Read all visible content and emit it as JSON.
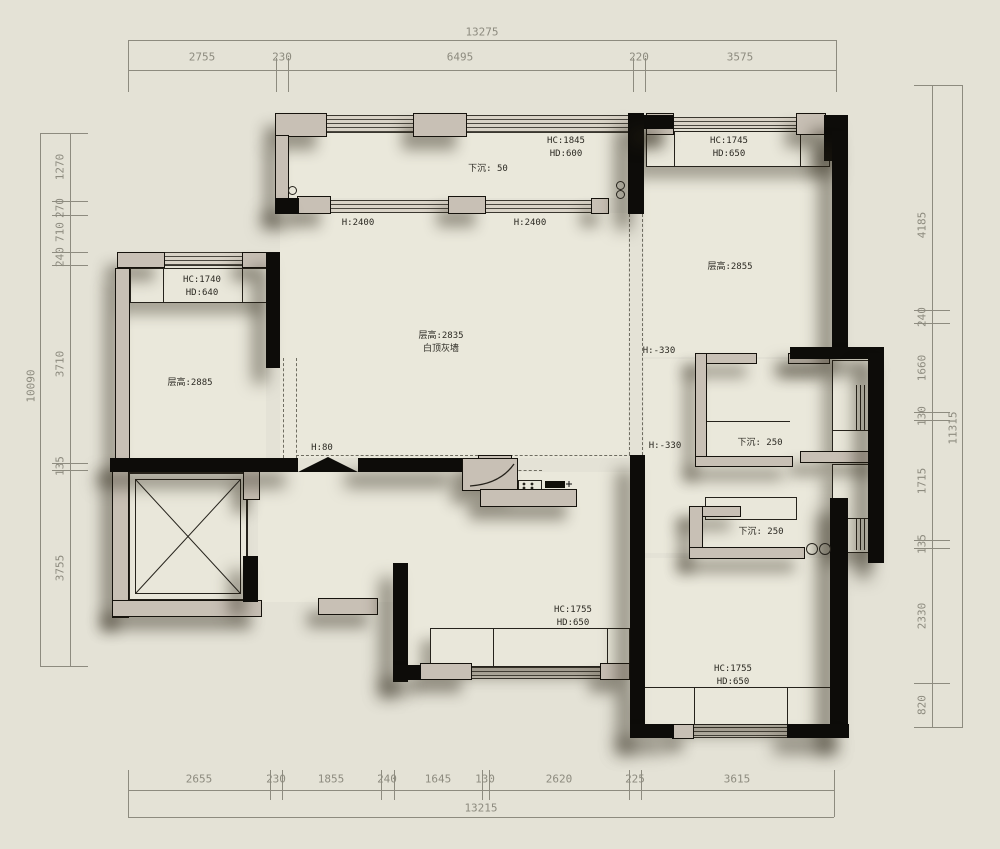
{
  "title": "apartment floor plan",
  "colors": {
    "background": "#e4e2d6",
    "wall": "#0d0c09",
    "trim": "#c8c0b5",
    "floor": "#eae8db",
    "dimension_text": "#8d8b7f",
    "annotation_text": "#2c2a23"
  },
  "dim_chains": {
    "top": {
      "total": "13275",
      "segments": [
        "2755",
        "230",
        "6495",
        "220",
        "3575"
      ]
    },
    "bottom": {
      "total": "13215",
      "segments": [
        "2655",
        "230",
        "1855",
        "240",
        "1645",
        "130",
        "2620",
        "225",
        "3615"
      ]
    },
    "left": {
      "total": "10090",
      "segments": [
        "1270",
        "270",
        "710",
        "240",
        "3710",
        "135",
        "3755"
      ]
    },
    "right": {
      "total": "11315",
      "segments": [
        "4185",
        "240",
        "1660",
        "130",
        "1715",
        "135",
        "2330",
        "820"
      ]
    }
  },
  "room_labels": [
    {
      "id": "balcony-window-spec",
      "lines": [
        "HC:1845",
        "HD:600"
      ]
    },
    {
      "id": "balcony-sunken",
      "lines": [
        "下沉: 50"
      ]
    },
    {
      "id": "bedroom2-window-spec",
      "lines": [
        "HC:1745",
        "HD:650"
      ]
    },
    {
      "id": "balcony-door-height-1",
      "lines": [
        "H:2400"
      ]
    },
    {
      "id": "balcony-door-height-2",
      "lines": [
        "H:2400"
      ]
    },
    {
      "id": "room-left-window-spec",
      "lines": [
        "HC:1740",
        "HD:640"
      ]
    },
    {
      "id": "room-left-height",
      "lines": [
        "层高:2885"
      ]
    },
    {
      "id": "living-height",
      "lines": [
        "层高:2835",
        "白顶灰墙"
      ]
    },
    {
      "id": "bedroom2-height",
      "lines": [
        "层高:2855"
      ]
    },
    {
      "id": "bath-level-1",
      "lines": [
        "H:-330"
      ]
    },
    {
      "id": "bath-level-2",
      "lines": [
        "H:-330"
      ]
    },
    {
      "id": "bath-sunken-1",
      "lines": [
        "下沉: 250"
      ]
    },
    {
      "id": "bath-sunken-2",
      "lines": [
        "下沉: 250"
      ]
    },
    {
      "id": "entry-level",
      "lines": [
        "H:80"
      ]
    },
    {
      "id": "kitchen-window-spec",
      "lines": [
        "HC:1755",
        "HD:650"
      ]
    },
    {
      "id": "bedroom3-window-spec",
      "lines": [
        "HC:1755",
        "HD:650"
      ]
    }
  ]
}
